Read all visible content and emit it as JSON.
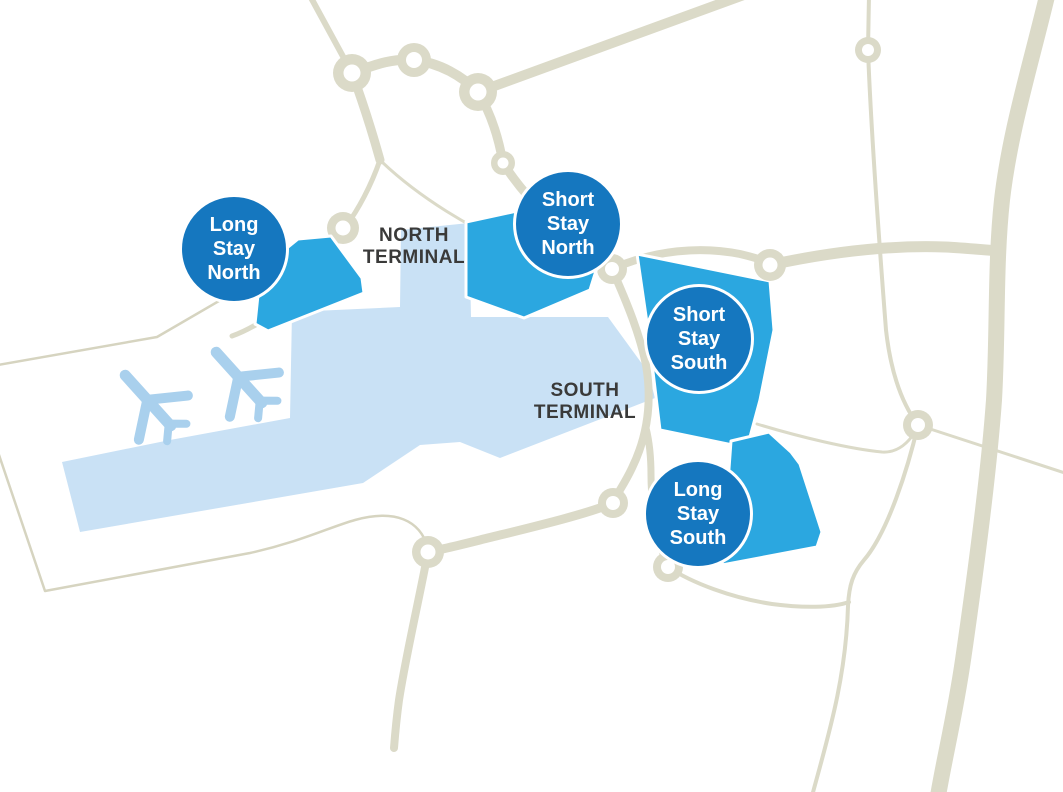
{
  "map": {
    "description": "Airport parking map",
    "colors": {
      "background": "#ffffff",
      "road": "#dbdac8",
      "boundary_line": "#d6d4c0",
      "terminal_area": "#c9e1f5",
      "airplane": "#a9d0ed",
      "parking_area": "#2ba7e0",
      "badge": "#1577bf",
      "badge_text": "#ffffff",
      "terminal_label_text": "#3a3a39"
    },
    "terminals": [
      {
        "id": "north-terminal",
        "lines": [
          "NORTH",
          "TERMINAL"
        ]
      },
      {
        "id": "south-terminal",
        "lines": [
          "SOUTH",
          "TERMINAL"
        ]
      }
    ],
    "parking_zones": [
      {
        "id": "long-stay-north",
        "lines": [
          "Long",
          "Stay",
          "North"
        ]
      },
      {
        "id": "short-stay-north",
        "lines": [
          "Short",
          "Stay",
          "North"
        ]
      },
      {
        "id": "short-stay-south",
        "lines": [
          "Short",
          "Stay",
          "South"
        ]
      },
      {
        "id": "long-stay-south",
        "lines": [
          "Long",
          "Stay",
          "South"
        ]
      }
    ],
    "icons": {
      "airplane": "airplane-icon",
      "junction": "road-junction-icon"
    }
  }
}
